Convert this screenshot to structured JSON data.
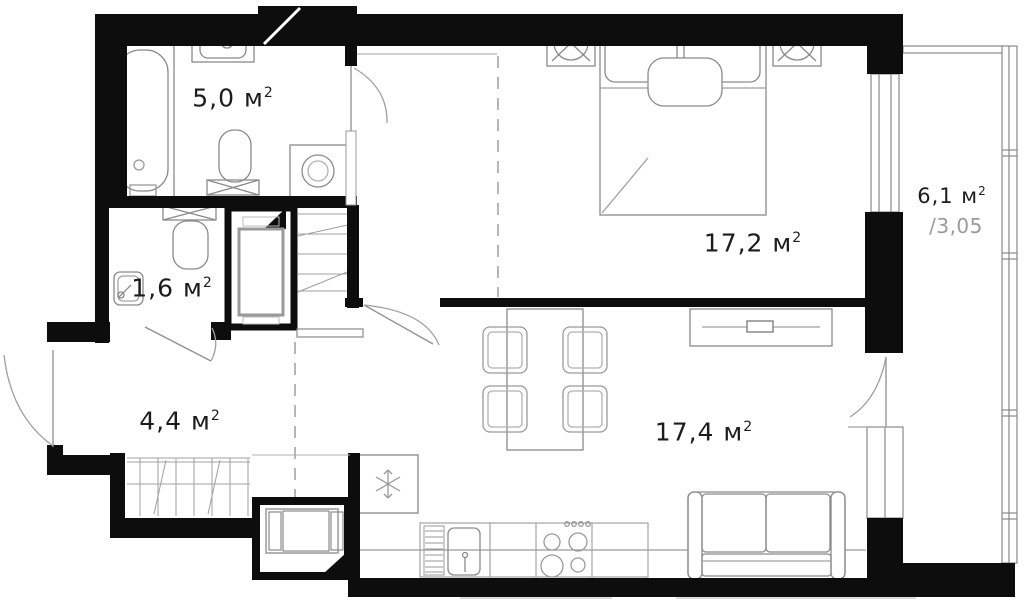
{
  "plan": {
    "title": "apartment-floor-plan",
    "rooms": [
      {
        "id": "bathroom",
        "area": "5,0",
        "unit": " м",
        "sup": "2"
      },
      {
        "id": "wc",
        "area": "1,6",
        "unit": " м",
        "sup": "2"
      },
      {
        "id": "hallway",
        "area": "4,4",
        "unit": " м",
        "sup": "2"
      },
      {
        "id": "bedroom",
        "area": "17,2",
        "unit": " м",
        "sup": "2"
      },
      {
        "id": "living-kitchen",
        "area": "17,4",
        "unit": " м",
        "sup": "2"
      },
      {
        "id": "balcony",
        "area": "6,1",
        "unit": " м",
        "sup": "2",
        "coefficient": "/3,05"
      }
    ],
    "colors": {
      "wall": "#0d0d0d",
      "furniture": "#8a8a8a",
      "light": "#b5b5b5",
      "label": "#1c1c1c",
      "muted": "#9b9b9b",
      "background": "#ffffff"
    }
  }
}
